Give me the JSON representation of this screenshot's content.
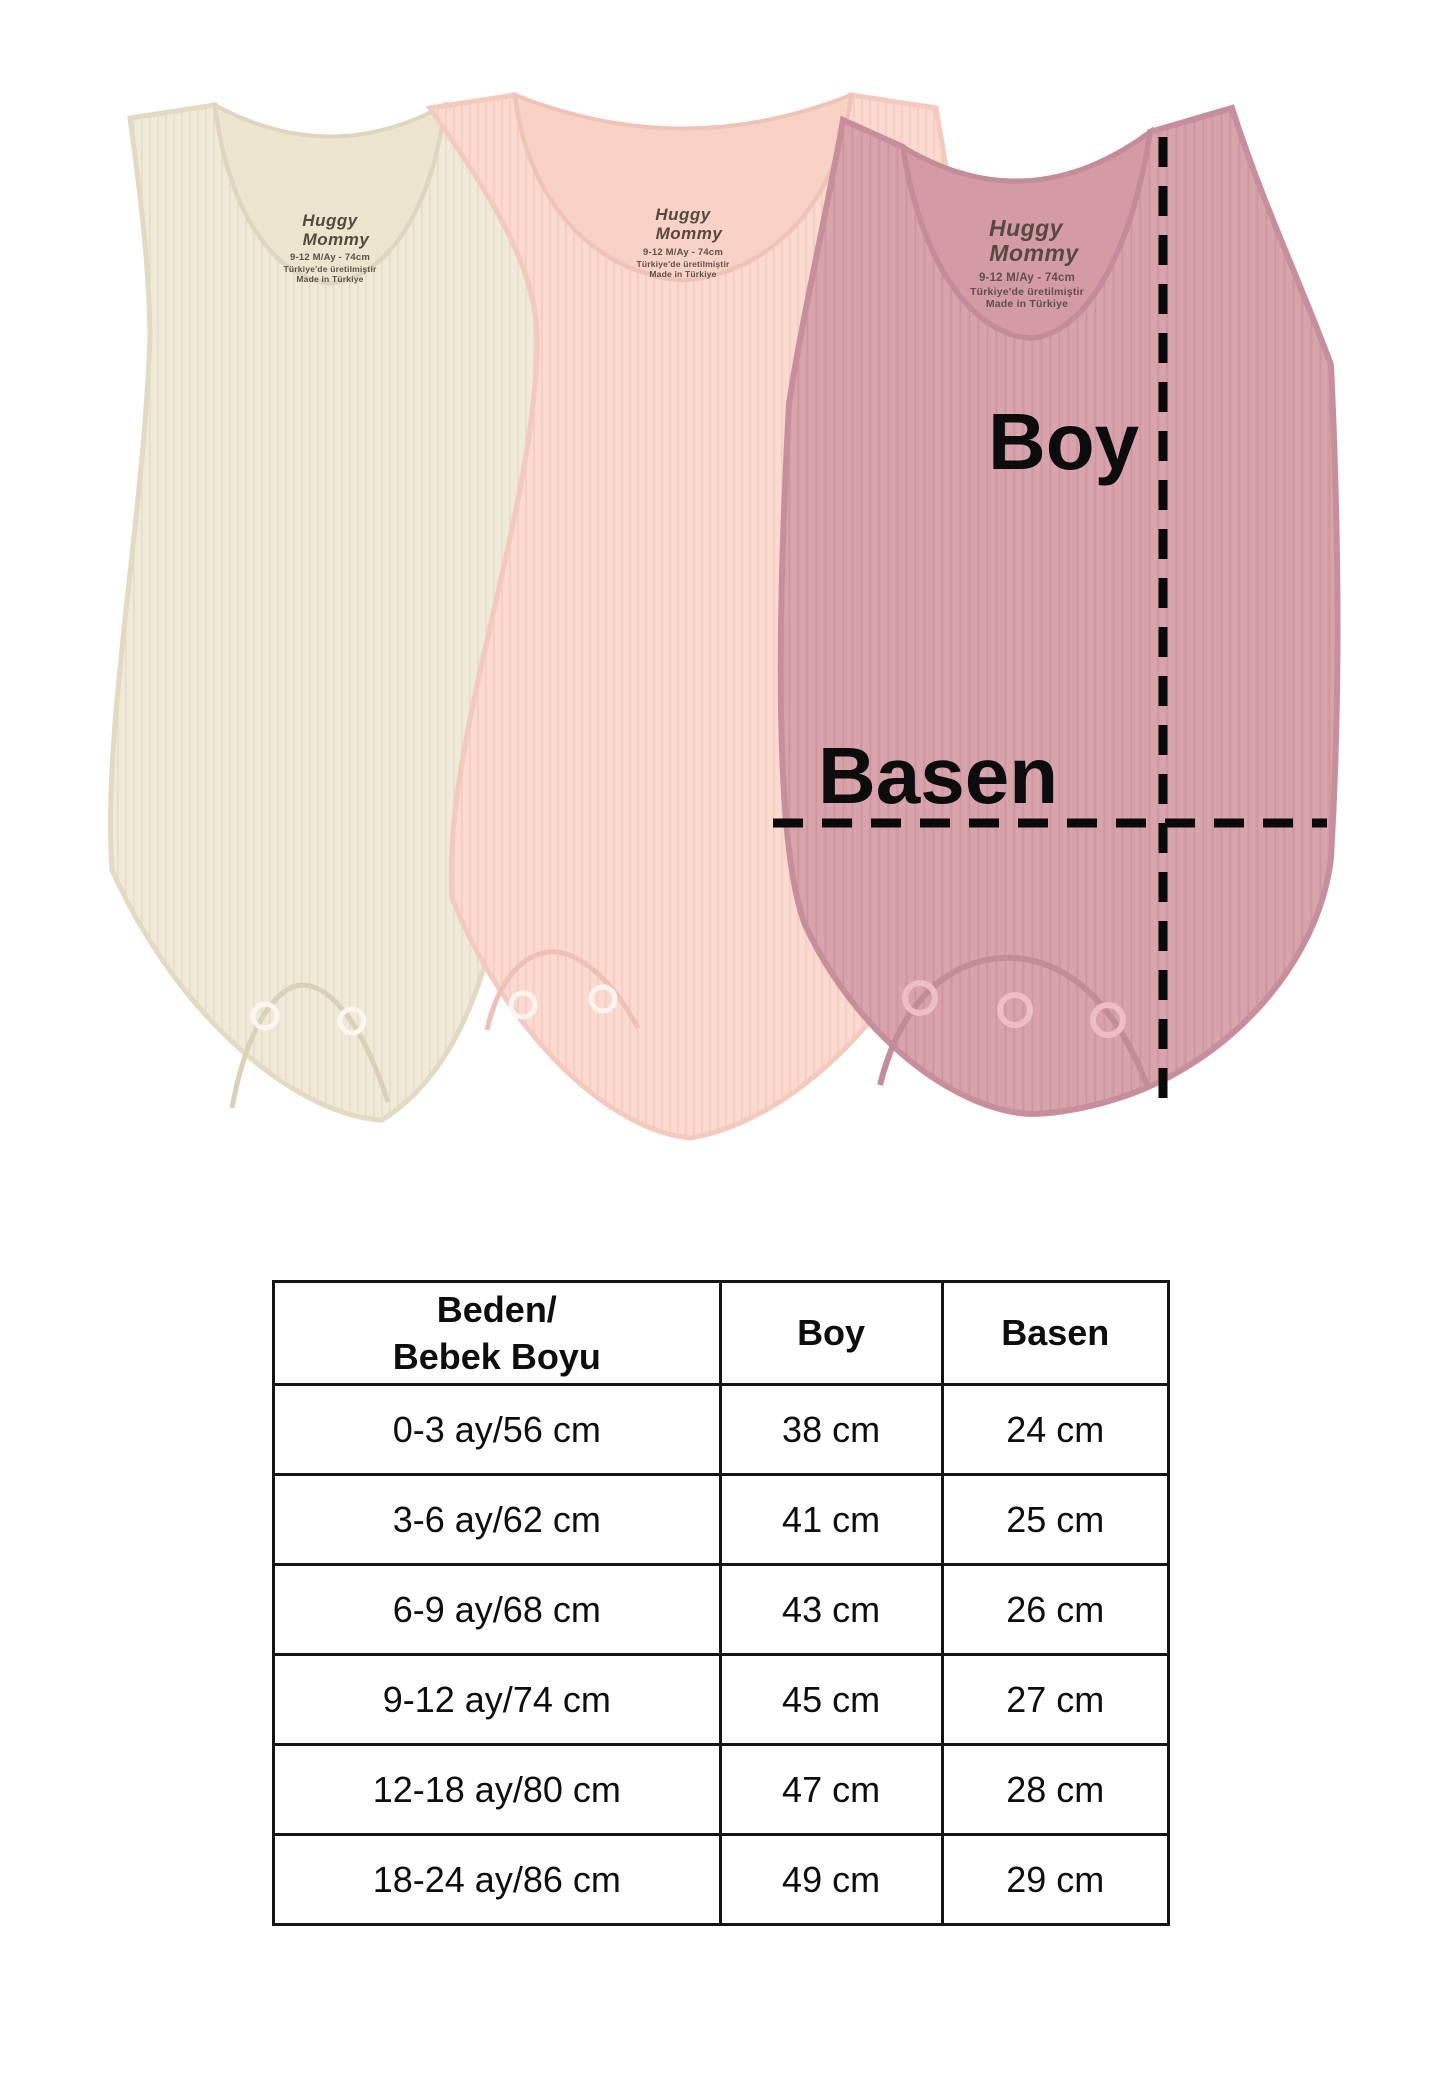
{
  "product": {
    "garment_colors": {
      "cream": "#f0ead8",
      "pink": "#fcdad0",
      "rose": "#d9a3ac"
    },
    "care_label": {
      "brand_line1": "Huggy",
      "brand_line2": "Mommy",
      "size_line": "9-12 M/Ay - 74cm",
      "origin_line1": "Türkiye'de üretilmiştir",
      "origin_line2": "Made in Türkiye"
    },
    "measure_annotations": {
      "length": "Boy",
      "hip": "Basen"
    }
  },
  "size_chart": {
    "header": {
      "col1_line1": "Beden/",
      "col1_line2": "Bebek Boyu",
      "col2": "Boy",
      "col3": "Basen"
    },
    "rows": [
      {
        "beden": "0-3 ay/56 cm",
        "boy": "38 cm",
        "basen": "24 cm"
      },
      {
        "beden": "3-6 ay/62 cm",
        "boy": "41 cm",
        "basen": "25 cm"
      },
      {
        "beden": "6-9 ay/68 cm",
        "boy": "43 cm",
        "basen": "26 cm"
      },
      {
        "beden": "9-12 ay/74 cm",
        "boy": "45 cm",
        "basen": "27 cm"
      },
      {
        "beden": "12-18 ay/80 cm",
        "boy": "47 cm",
        "basen": "28 cm"
      },
      {
        "beden": "18-24 ay/86 cm",
        "boy": "49 cm",
        "basen": "29 cm"
      }
    ]
  }
}
